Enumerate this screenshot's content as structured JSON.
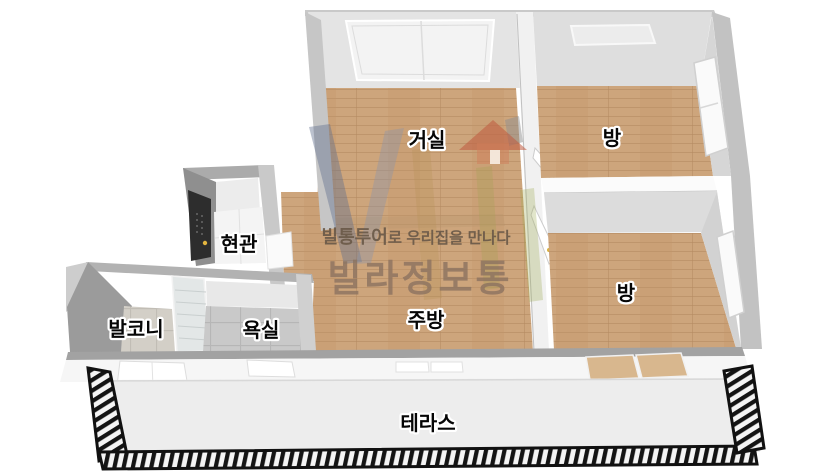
{
  "floorplan": {
    "rooms": [
      {
        "id": "living-room",
        "label": "거실"
      },
      {
        "id": "bedroom-top",
        "label": "방"
      },
      {
        "id": "bedroom-bottom",
        "label": "방"
      },
      {
        "id": "entrance",
        "label": "현관"
      },
      {
        "id": "balcony",
        "label": "발코니"
      },
      {
        "id": "bathroom",
        "label": "욕실"
      },
      {
        "id": "kitchen",
        "label": "주방"
      },
      {
        "id": "terrace",
        "label": "테라스"
      }
    ],
    "colors": {
      "background": "#ffffff",
      "wood_floor": "#cda57c",
      "wall_top": "#a9a9a9",
      "wall_face": "#d9d9d9",
      "bathroom_tile": "#c9c9c9",
      "terrace_floor": "#ededed",
      "railing": "#141414",
      "entrance_door": "#2d2d2d"
    }
  },
  "watermark": {
    "tagline_bold": "빌통투어",
    "tagline_rest": "로 우리집을 만나다",
    "brand": "빌라정보통",
    "logo_house_color": "#c0593e"
  }
}
